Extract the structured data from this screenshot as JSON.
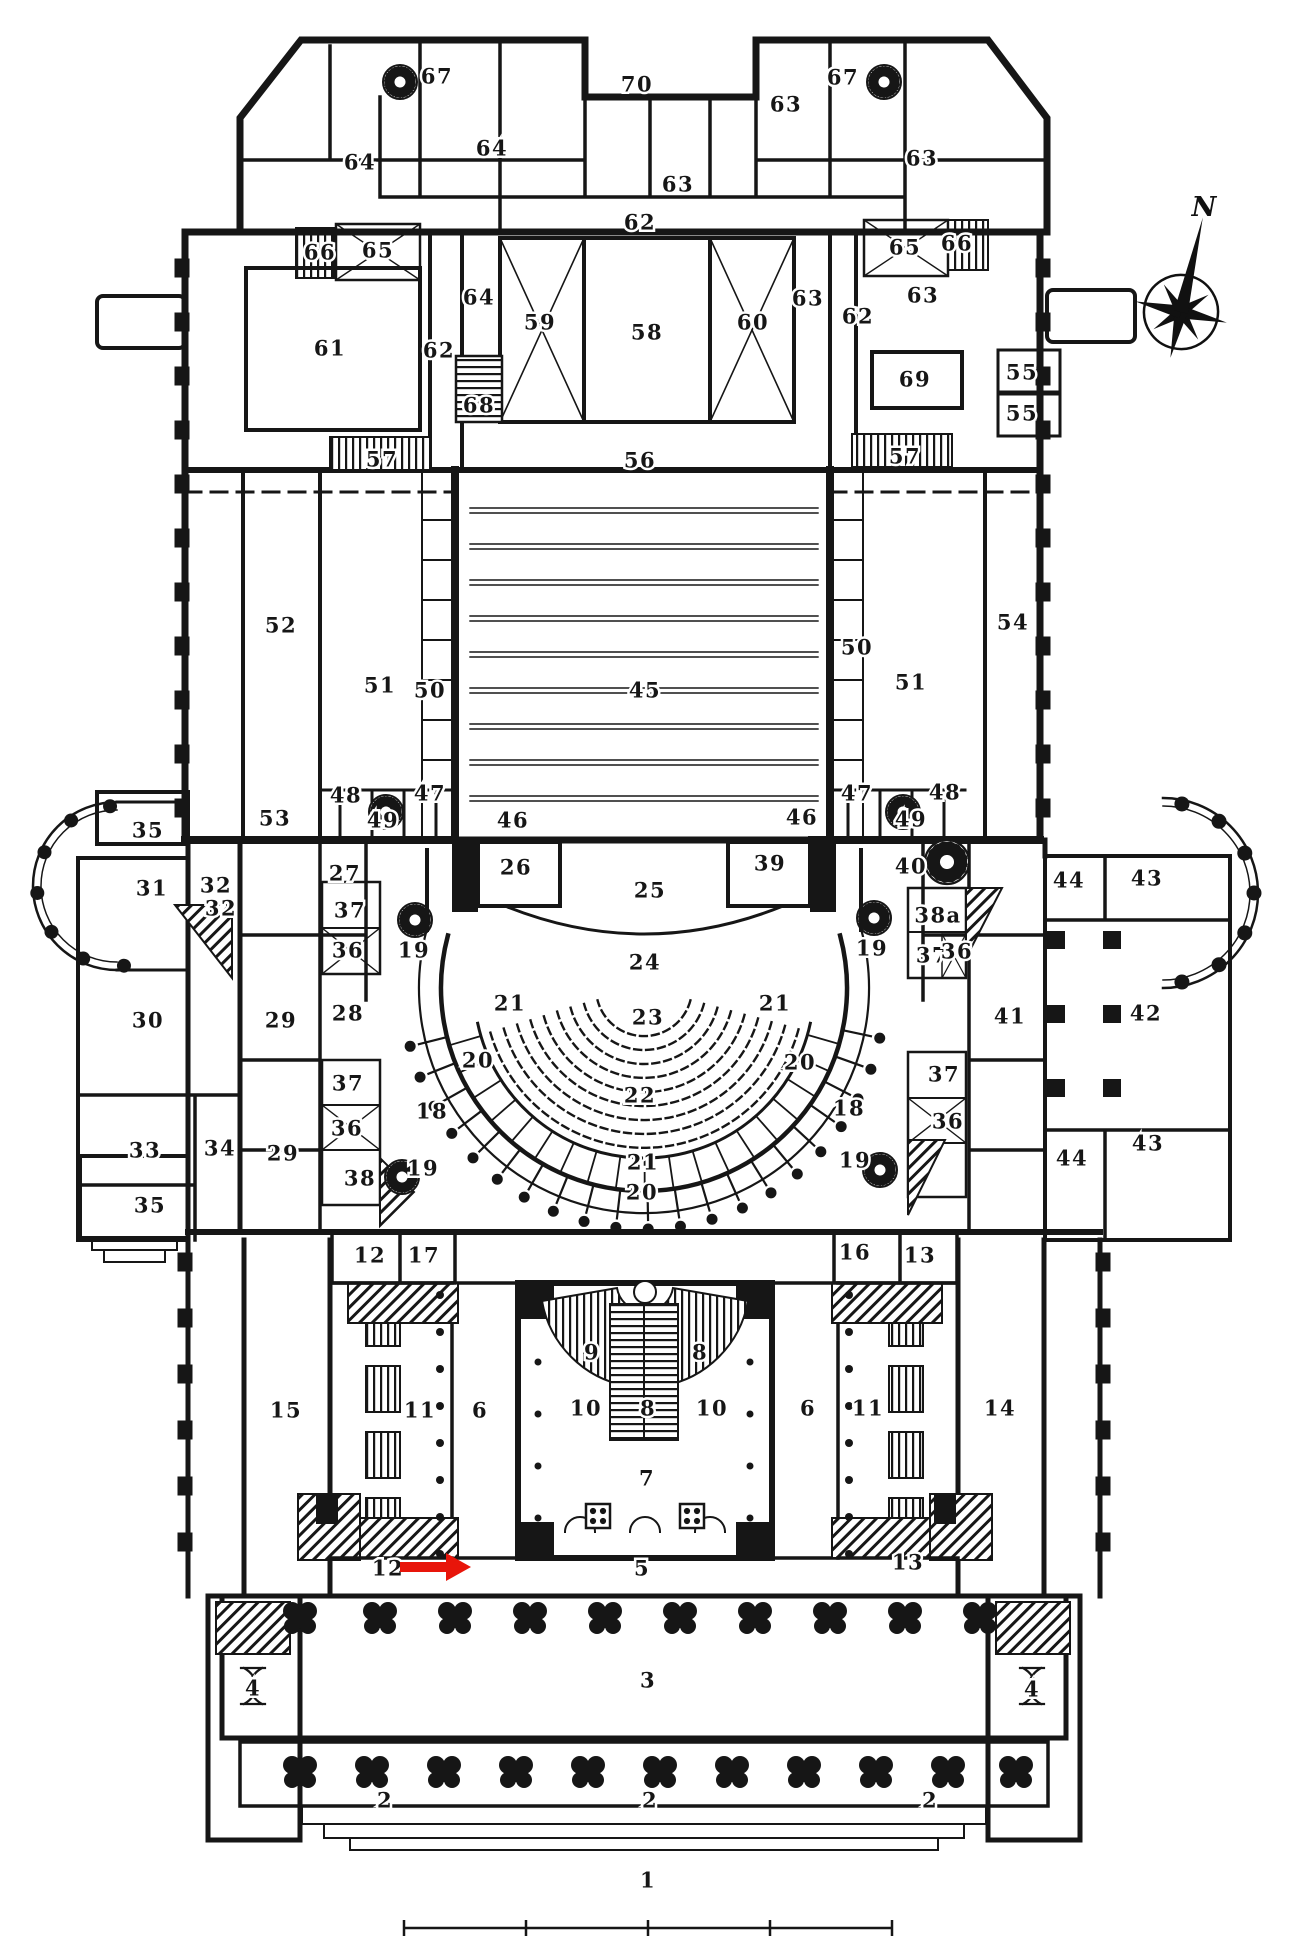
{
  "compass": {
    "north_label": "N"
  },
  "pointer_annotation": {
    "target_room": "12",
    "direction": "right",
    "color": "#e8150a"
  },
  "scale_bar": {
    "divisions": 4
  },
  "colors": {
    "ink": "#161616",
    "paper": "#ffffff",
    "annotation_red": "#e8150a"
  },
  "plan": {
    "labels": [
      {
        "t": "70",
        "x": 637,
        "y": 84
      },
      {
        "t": "67",
        "x": 437,
        "y": 76
      },
      {
        "t": "67",
        "x": 843,
        "y": 77
      },
      {
        "t": "64",
        "x": 492,
        "y": 148
      },
      {
        "t": "63",
        "x": 786,
        "y": 104
      },
      {
        "t": "64",
        "x": 360,
        "y": 162
      },
      {
        "t": "63",
        "x": 922,
        "y": 158
      },
      {
        "t": "63",
        "x": 678,
        "y": 184
      },
      {
        "t": "62",
        "x": 640,
        "y": 222
      },
      {
        "t": "66",
        "x": 320,
        "y": 252,
        "s": 19
      },
      {
        "t": "65",
        "x": 378,
        "y": 250,
        "s": 19
      },
      {
        "t": "65",
        "x": 905,
        "y": 247,
        "s": 19
      },
      {
        "t": "66",
        "x": 957,
        "y": 243,
        "s": 19
      },
      {
        "t": "64",
        "x": 479,
        "y": 297
      },
      {
        "t": "63",
        "x": 923,
        "y": 295
      },
      {
        "t": "63",
        "x": 808,
        "y": 298,
        "s": 19
      },
      {
        "t": "61",
        "x": 330,
        "y": 348
      },
      {
        "t": "62",
        "x": 439,
        "y": 350
      },
      {
        "t": "62",
        "x": 858,
        "y": 316
      },
      {
        "t": "59",
        "x": 540,
        "y": 322
      },
      {
        "t": "58",
        "x": 647,
        "y": 332
      },
      {
        "t": "60",
        "x": 753,
        "y": 322
      },
      {
        "t": "68",
        "x": 479,
        "y": 405,
        "s": 18
      },
      {
        "t": "69",
        "x": 915,
        "y": 379
      },
      {
        "t": "55",
        "x": 1022,
        "y": 372,
        "s": 19
      },
      {
        "t": "55",
        "x": 1022,
        "y": 413,
        "s": 19
      },
      {
        "t": "57",
        "x": 382,
        "y": 459,
        "s": 20
      },
      {
        "t": "57",
        "x": 905,
        "y": 456,
        "s": 20
      },
      {
        "t": "56",
        "x": 640,
        "y": 460
      },
      {
        "t": "52",
        "x": 281,
        "y": 625
      },
      {
        "t": "54",
        "x": 1013,
        "y": 622
      },
      {
        "t": "51",
        "x": 380,
        "y": 685
      },
      {
        "t": "50",
        "x": 430,
        "y": 690
      },
      {
        "t": "50",
        "x": 857,
        "y": 647
      },
      {
        "t": "51",
        "x": 911,
        "y": 682
      },
      {
        "t": "45",
        "x": 645,
        "y": 690
      },
      {
        "t": "53",
        "x": 275,
        "y": 818
      },
      {
        "t": "48",
        "x": 346,
        "y": 795,
        "s": 18
      },
      {
        "t": "47",
        "x": 430,
        "y": 793,
        "s": 18
      },
      {
        "t": "49",
        "x": 383,
        "y": 820,
        "s": 18
      },
      {
        "t": "46",
        "x": 513,
        "y": 820
      },
      {
        "t": "46",
        "x": 802,
        "y": 817
      },
      {
        "t": "47",
        "x": 857,
        "y": 793,
        "s": 18
      },
      {
        "t": "48",
        "x": 945,
        "y": 792,
        "s": 18
      },
      {
        "t": "49",
        "x": 911,
        "y": 819,
        "s": 18
      },
      {
        "t": "39",
        "x": 770,
        "y": 863
      },
      {
        "t": "40",
        "x": 911,
        "y": 866
      },
      {
        "t": "35",
        "x": 148,
        "y": 830
      },
      {
        "t": "31",
        "x": 152,
        "y": 888
      },
      {
        "t": "32",
        "x": 216,
        "y": 885,
        "s": 17
      },
      {
        "t": "32",
        "x": 221,
        "y": 908,
        "s": 17
      },
      {
        "t": "27",
        "x": 345,
        "y": 873
      },
      {
        "t": "26",
        "x": 516,
        "y": 867
      },
      {
        "t": "25",
        "x": 650,
        "y": 890
      },
      {
        "t": "19",
        "x": 414,
        "y": 950,
        "s": 18
      },
      {
        "t": "19",
        "x": 872,
        "y": 948,
        "s": 18
      },
      {
        "t": "37",
        "x": 350,
        "y": 910,
        "s": 17
      },
      {
        "t": "36",
        "x": 348,
        "y": 950,
        "s": 16
      },
      {
        "t": "38a",
        "x": 938,
        "y": 915,
        "s": 17
      },
      {
        "t": "37",
        "x": 932,
        "y": 955,
        "s": 17
      },
      {
        "t": "36",
        "x": 957,
        "y": 951,
        "s": 15
      },
      {
        "t": "44",
        "x": 1069,
        "y": 880,
        "s": 19
      },
      {
        "t": "43",
        "x": 1147,
        "y": 878
      },
      {
        "t": "30",
        "x": 148,
        "y": 1020
      },
      {
        "t": "29",
        "x": 281,
        "y": 1020
      },
      {
        "t": "28",
        "x": 348,
        "y": 1013
      },
      {
        "t": "41",
        "x": 1010,
        "y": 1016
      },
      {
        "t": "42",
        "x": 1146,
        "y": 1013
      },
      {
        "t": "24",
        "x": 645,
        "y": 962,
        "s": 19
      },
      {
        "t": "23",
        "x": 648,
        "y": 1017
      },
      {
        "t": "22",
        "x": 640,
        "y": 1095,
        "s": 20
      },
      {
        "t": "21",
        "x": 510,
        "y": 1003,
        "s": 17
      },
      {
        "t": "21",
        "x": 775,
        "y": 1003,
        "s": 17
      },
      {
        "t": "20",
        "x": 478,
        "y": 1060,
        "s": 19
      },
      {
        "t": "20",
        "x": 800,
        "y": 1062,
        "s": 19
      },
      {
        "t": "18",
        "x": 432,
        "y": 1111
      },
      {
        "t": "18",
        "x": 849,
        "y": 1108
      },
      {
        "t": "19",
        "x": 423,
        "y": 1168,
        "s": 18
      },
      {
        "t": "19",
        "x": 855,
        "y": 1160,
        "s": 18
      },
      {
        "t": "37",
        "x": 348,
        "y": 1083,
        "s": 17
      },
      {
        "t": "36",
        "x": 347,
        "y": 1128,
        "s": 16
      },
      {
        "t": "38",
        "x": 360,
        "y": 1178,
        "s": 17
      },
      {
        "t": "37",
        "x": 944,
        "y": 1074,
        "s": 17
      },
      {
        "t": "36",
        "x": 948,
        "y": 1121,
        "s": 16
      },
      {
        "t": "33",
        "x": 145,
        "y": 1150
      },
      {
        "t": "34",
        "x": 220,
        "y": 1148,
        "s": 18
      },
      {
        "t": "35",
        "x": 150,
        "y": 1205
      },
      {
        "t": "29",
        "x": 283,
        "y": 1153
      },
      {
        "t": "44",
        "x": 1072,
        "y": 1158,
        "s": 19
      },
      {
        "t": "43",
        "x": 1148,
        "y": 1143
      },
      {
        "t": "21",
        "x": 643,
        "y": 1162,
        "s": 18
      },
      {
        "t": "20",
        "x": 642,
        "y": 1192,
        "s": 18
      },
      {
        "t": "12",
        "x": 370,
        "y": 1255
      },
      {
        "t": "17",
        "x": 424,
        "y": 1255,
        "s": 19
      },
      {
        "t": "16",
        "x": 855,
        "y": 1252,
        "s": 19
      },
      {
        "t": "13",
        "x": 920,
        "y": 1255
      },
      {
        "t": "15",
        "x": 286,
        "y": 1410
      },
      {
        "t": "11",
        "x": 420,
        "y": 1410
      },
      {
        "t": "6",
        "x": 480,
        "y": 1410
      },
      {
        "t": "6",
        "x": 808,
        "y": 1408
      },
      {
        "t": "11",
        "x": 868,
        "y": 1408
      },
      {
        "t": "14",
        "x": 1000,
        "y": 1408
      },
      {
        "t": "9",
        "x": 592,
        "y": 1352
      },
      {
        "t": "8",
        "x": 700,
        "y": 1352
      },
      {
        "t": "10",
        "x": 586,
        "y": 1408
      },
      {
        "t": "8",
        "x": 648,
        "y": 1408
      },
      {
        "t": "10",
        "x": 712,
        "y": 1408
      },
      {
        "t": "7",
        "x": 647,
        "y": 1478
      },
      {
        "t": "12",
        "x": 388,
        "y": 1568
      },
      {
        "t": "5",
        "x": 642,
        "y": 1568
      },
      {
        "t": "13",
        "x": 908,
        "y": 1562
      },
      {
        "t": "4",
        "x": 253,
        "y": 1688
      },
      {
        "t": "3",
        "x": 648,
        "y": 1680
      },
      {
        "t": "4",
        "x": 1032,
        "y": 1689
      },
      {
        "t": "2",
        "x": 385,
        "y": 1800
      },
      {
        "t": "2",
        "x": 650,
        "y": 1800
      },
      {
        "t": "2",
        "x": 930,
        "y": 1800
      },
      {
        "t": "1",
        "x": 648,
        "y": 1880
      }
    ]
  }
}
